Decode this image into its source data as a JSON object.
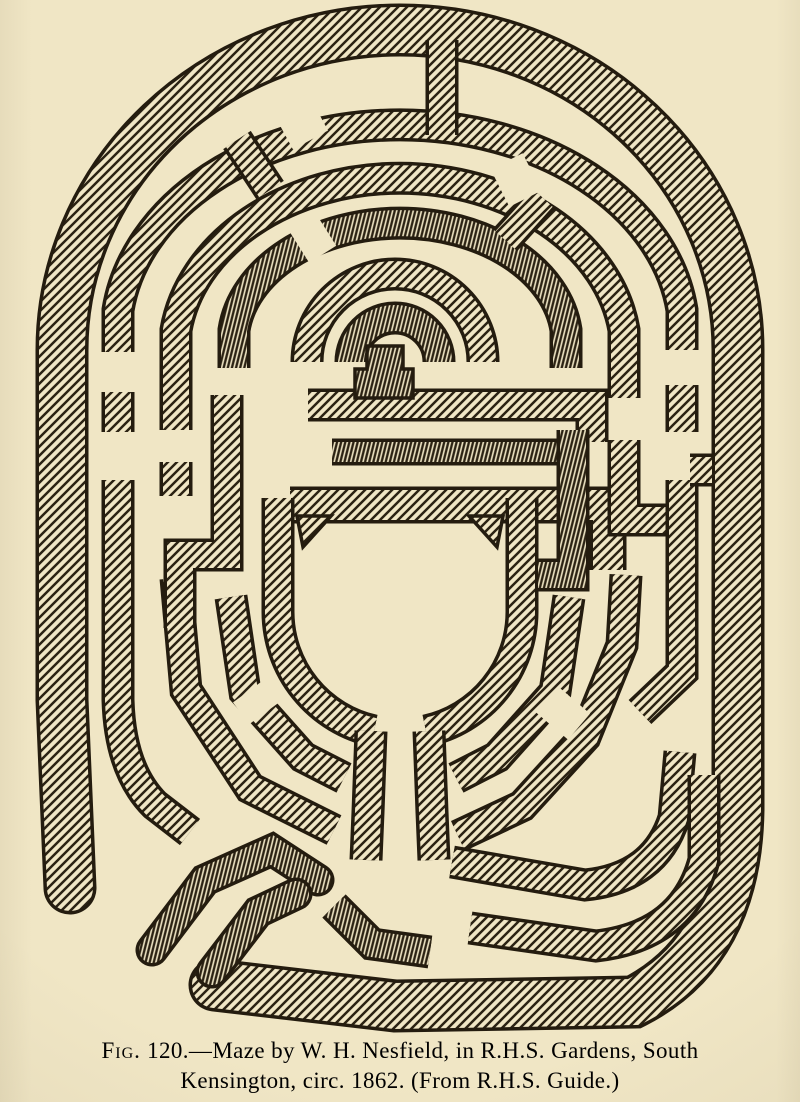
{
  "page": {
    "paper_color": "#f0e6c5",
    "ink_color": "#241c0f",
    "hatch_color": "#2b2213"
  },
  "figure": {
    "fig_label": "Fig.",
    "caption_line1_rest": " 120.—Maze by W. H. Nesfield, in R.H.S. Gardens, South",
    "caption_line2": "Kensington, circ. 1862.  (From R.H.S. Guide.)"
  },
  "maze": {
    "walls": [
      {
        "name": "outer-wall",
        "d": "M 70,888 L 62,700 L 62,350 A 338,320 0 0 1 400,30 A 338,320 0 0 1 738,350 L 738,810 Q 736,950 634,1002 L 395,1006 L 215,985",
        "w": 46,
        "cap": "round",
        "p": "hatch"
      },
      {
        "name": "ring-d",
        "d": "M 118,432 L 118,310 A 284,210 0 0 1 682,310 L 682,432",
        "w": 26,
        "p": "hatch"
      },
      {
        "name": "ring-c",
        "d": "M 176,496 L 176,330 A 226,175 0 0 1 624,330 L 624,398",
        "w": 26,
        "p": "hatch"
      },
      {
        "name": "ring-b",
        "d": "M 234,368 L 234,330 A 167,120 0 0 1 566,330 L 566,368",
        "w": 26,
        "p": "hatchv"
      },
      {
        "name": "fan-outer",
        "d": "M 307,362 A 88,88 0 0 1 483,362",
        "w": 26,
        "p": "hatch"
      },
      {
        "name": "fan-inner",
        "d": "M 351,362 A 44,44 0 0 1 439,362",
        "w": 26,
        "p": "hatchv"
      },
      {
        "name": "bump-bar",
        "d": "M 308,405 L 592,405 L 592,442",
        "w": 26,
        "p": "hatch"
      },
      {
        "name": "thin-bar",
        "d": "M 332,452 L 560,452",
        "w": 20,
        "p": "hatchv"
      },
      {
        "name": "main-bar",
        "d": "M 290,505 L 608,505 L 608,570",
        "w": 30,
        "p": "hatch"
      },
      {
        "name": "centre-ring-left",
        "d": "M 278,498 L 278,612 A 122,122 0 0 0 374,731",
        "w": 26,
        "p": "hatch"
      },
      {
        "name": "centre-ring-right",
        "d": "M 522,498 L 522,612 A 122,122 0 0 1 426,731",
        "w": 26,
        "p": "hatch"
      },
      {
        "name": "stem-left",
        "d": "M 371,731 L 368,812 L 366,860",
        "w": 26,
        "p": "hatch"
      },
      {
        "name": "stem-right",
        "d": "M 429,731 L 432,812 L 434,860",
        "w": 26,
        "p": "hatch"
      },
      {
        "name": "ring-e-left",
        "d": "M 231,597 L 245,692 L 303,757 L 344,778",
        "w": 26,
        "p": "hatch"
      },
      {
        "name": "ring-e-right",
        "d": "M 456,778 L 497,757 L 555,692 L 569,597",
        "w": 26,
        "p": "hatch"
      },
      {
        "name": "ring-f-left",
        "d": "M 176,578 L 186,690 L 250,788 L 334,830",
        "w": 26,
        "p": "hatch"
      },
      {
        "name": "ring-f-right",
        "d": "M 458,836 L 522,806 L 585,737 L 622,645 L 626,575",
        "w": 26,
        "p": "hatch"
      },
      {
        "name": "left-meander",
        "d": "M 227,395 L 227,555 L 180,555 L 180,628",
        "w": 26,
        "p": "hatch"
      },
      {
        "name": "right-meander-a",
        "d": "M 573,430 L 573,575 L 538,575",
        "w": 26,
        "p": "hatchv"
      },
      {
        "name": "right-meander-b",
        "d": "M 624,440 L 624,520 L 690,520",
        "w": 26,
        "p": "hatch"
      },
      {
        "name": "right-wall-low",
        "d": "M 682,480 L 682,672 L 640,712",
        "w": 26,
        "p": "hatch"
      },
      {
        "name": "corner-band-1",
        "d": "M 452,862 L 585,885 Q 655,878 674,818 L 680,752",
        "w": 26,
        "p": "hatch"
      },
      {
        "name": "corner-band-2",
        "d": "M 470,928 L 596,946 Q 684,936 704,860 L 704,775",
        "w": 26,
        "p": "hatch"
      },
      {
        "name": "notch-band-1",
        "d": "M 152,950 L 205,880 L 272,850 L 318,880",
        "w": 26,
        "cap": "round",
        "p": "hatchv"
      },
      {
        "name": "notch-band-2",
        "d": "M 212,972 L 258,912 L 296,894",
        "w": 26,
        "cap": "round",
        "p": "hatchv"
      },
      {
        "name": "under-stem-band",
        "d": "M 334,906 L 372,944 L 430,952",
        "w": 26,
        "p": "hatchv"
      },
      {
        "name": "top-spoke-centre",
        "d": "M 442,40 L 442,135",
        "w": 26,
        "p": "hatch"
      },
      {
        "name": "top-spoke-left",
        "d": "M 270,190 L 237,140",
        "w": 26,
        "p": "hatch"
      },
      {
        "name": "top-spoke-right",
        "d": "M 505,240 L 543,198",
        "w": 26,
        "p": "hatch"
      },
      {
        "name": "right-bridge",
        "d": "M 712,470 L 690,470",
        "w": 26,
        "p": "hatch"
      },
      {
        "name": "left-wall-low",
        "d": "M 118,480 L 118,700 Q 120,770 155,805 L 190,832",
        "w": 26,
        "p": "hatch"
      }
    ],
    "cuts": [
      {
        "name": "gap-ring-d-top",
        "d": "M 283,131 L 318,112",
        "w": 42
      },
      {
        "name": "gap-ring-c-top",
        "d": "M 500,188 L 532,172",
        "w": 42
      },
      {
        "name": "gap-ring-b-top",
        "d": "M 298,245 L 325,228",
        "w": 42
      },
      {
        "name": "gap-ring-d-left",
        "d": "M 118,352 L 118,392",
        "w": 42
      },
      {
        "name": "gap-ring-f-right",
        "d": "M 574,700 L 552,726",
        "w": 42
      },
      {
        "name": "gap-ring-e-left",
        "d": "M 250,690 L 266,712",
        "w": 42
      },
      {
        "name": "gap-ring-d-right",
        "d": "M 682,350 L 682,385",
        "w": 42
      },
      {
        "name": "gap-ring-c-left",
        "d": "M 176,430 L 176,462",
        "w": 42
      }
    ],
    "fills": [
      {
        "name": "castle-bump",
        "d": "M 355,398 L 355,369 L 367,369 L 367,346 L 403,346 L 403,369 L 413,369 L 413,398 Z",
        "p": "hatchv"
      },
      {
        "name": "marker-triangle-left",
        "d": "M 297,516 L 331,516 L 303,547 Z",
        "p": "hatch"
      },
      {
        "name": "marker-triangle-right",
        "d": "M 469,516 L 503,516 L 497,547 Z",
        "p": "hatch"
      }
    ]
  }
}
